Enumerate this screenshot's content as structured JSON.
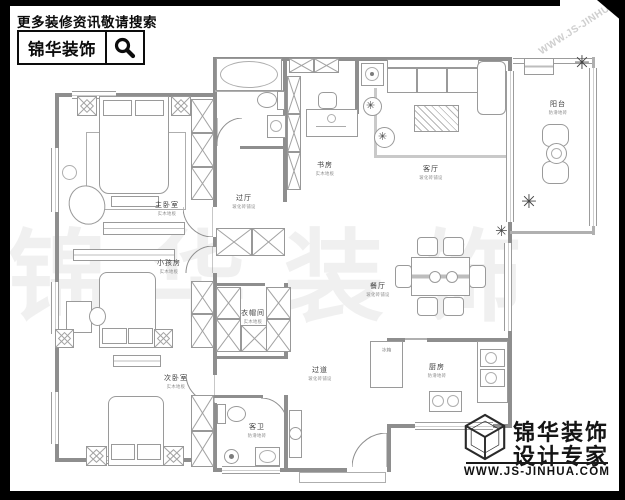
{
  "header": {
    "slogan": "更多装修资讯敬请搜索",
    "brand": "锦华装饰",
    "search_icon": "magnifier-icon"
  },
  "watermark": {
    "text": "锦华装饰",
    "diagonal_url": "WWW.JS-JINHUA.COM"
  },
  "footer": {
    "brand_line1": "锦华装饰",
    "brand_line2": "设计专家",
    "url": "WWW.JS-JINHUA.COM",
    "logo_icon": "wireframe-cube-icon"
  },
  "rooms": [
    {
      "id": "master-bedroom",
      "name": "主卧室",
      "finish": "实木地板"
    },
    {
      "id": "kids-room",
      "name": "小孩房",
      "finish": "实木地板"
    },
    {
      "id": "second-bedroom",
      "name": "次卧室",
      "finish": "实木地板"
    },
    {
      "id": "hall",
      "name": "过厅",
      "finish": "玻化砖铺设"
    },
    {
      "id": "study",
      "name": "书房",
      "finish": "实木地板"
    },
    {
      "id": "living-room",
      "name": "客厅",
      "finish": "玻化砖铺设"
    },
    {
      "id": "balcony",
      "name": "阳台",
      "finish": "防滑地砖"
    },
    {
      "id": "cloakroom",
      "name": "衣帽间",
      "finish": "实木地板"
    },
    {
      "id": "dining-room",
      "name": "餐厅",
      "finish": "玻化砖铺设"
    },
    {
      "id": "corridor",
      "name": "过道",
      "finish": "玻化砖铺设"
    },
    {
      "id": "guest-bath",
      "name": "客卫",
      "finish": "防滑地砖"
    },
    {
      "id": "kitchen",
      "name": "厨房",
      "finish": "防滑地砖"
    }
  ],
  "furniture_labels": {
    "fridge": "冰箱"
  },
  "colors": {
    "wall": "#8e8e8e",
    "furniture_stroke": "#9a9a9a",
    "frame": "#000000",
    "watermark": "#e8e8e8"
  }
}
